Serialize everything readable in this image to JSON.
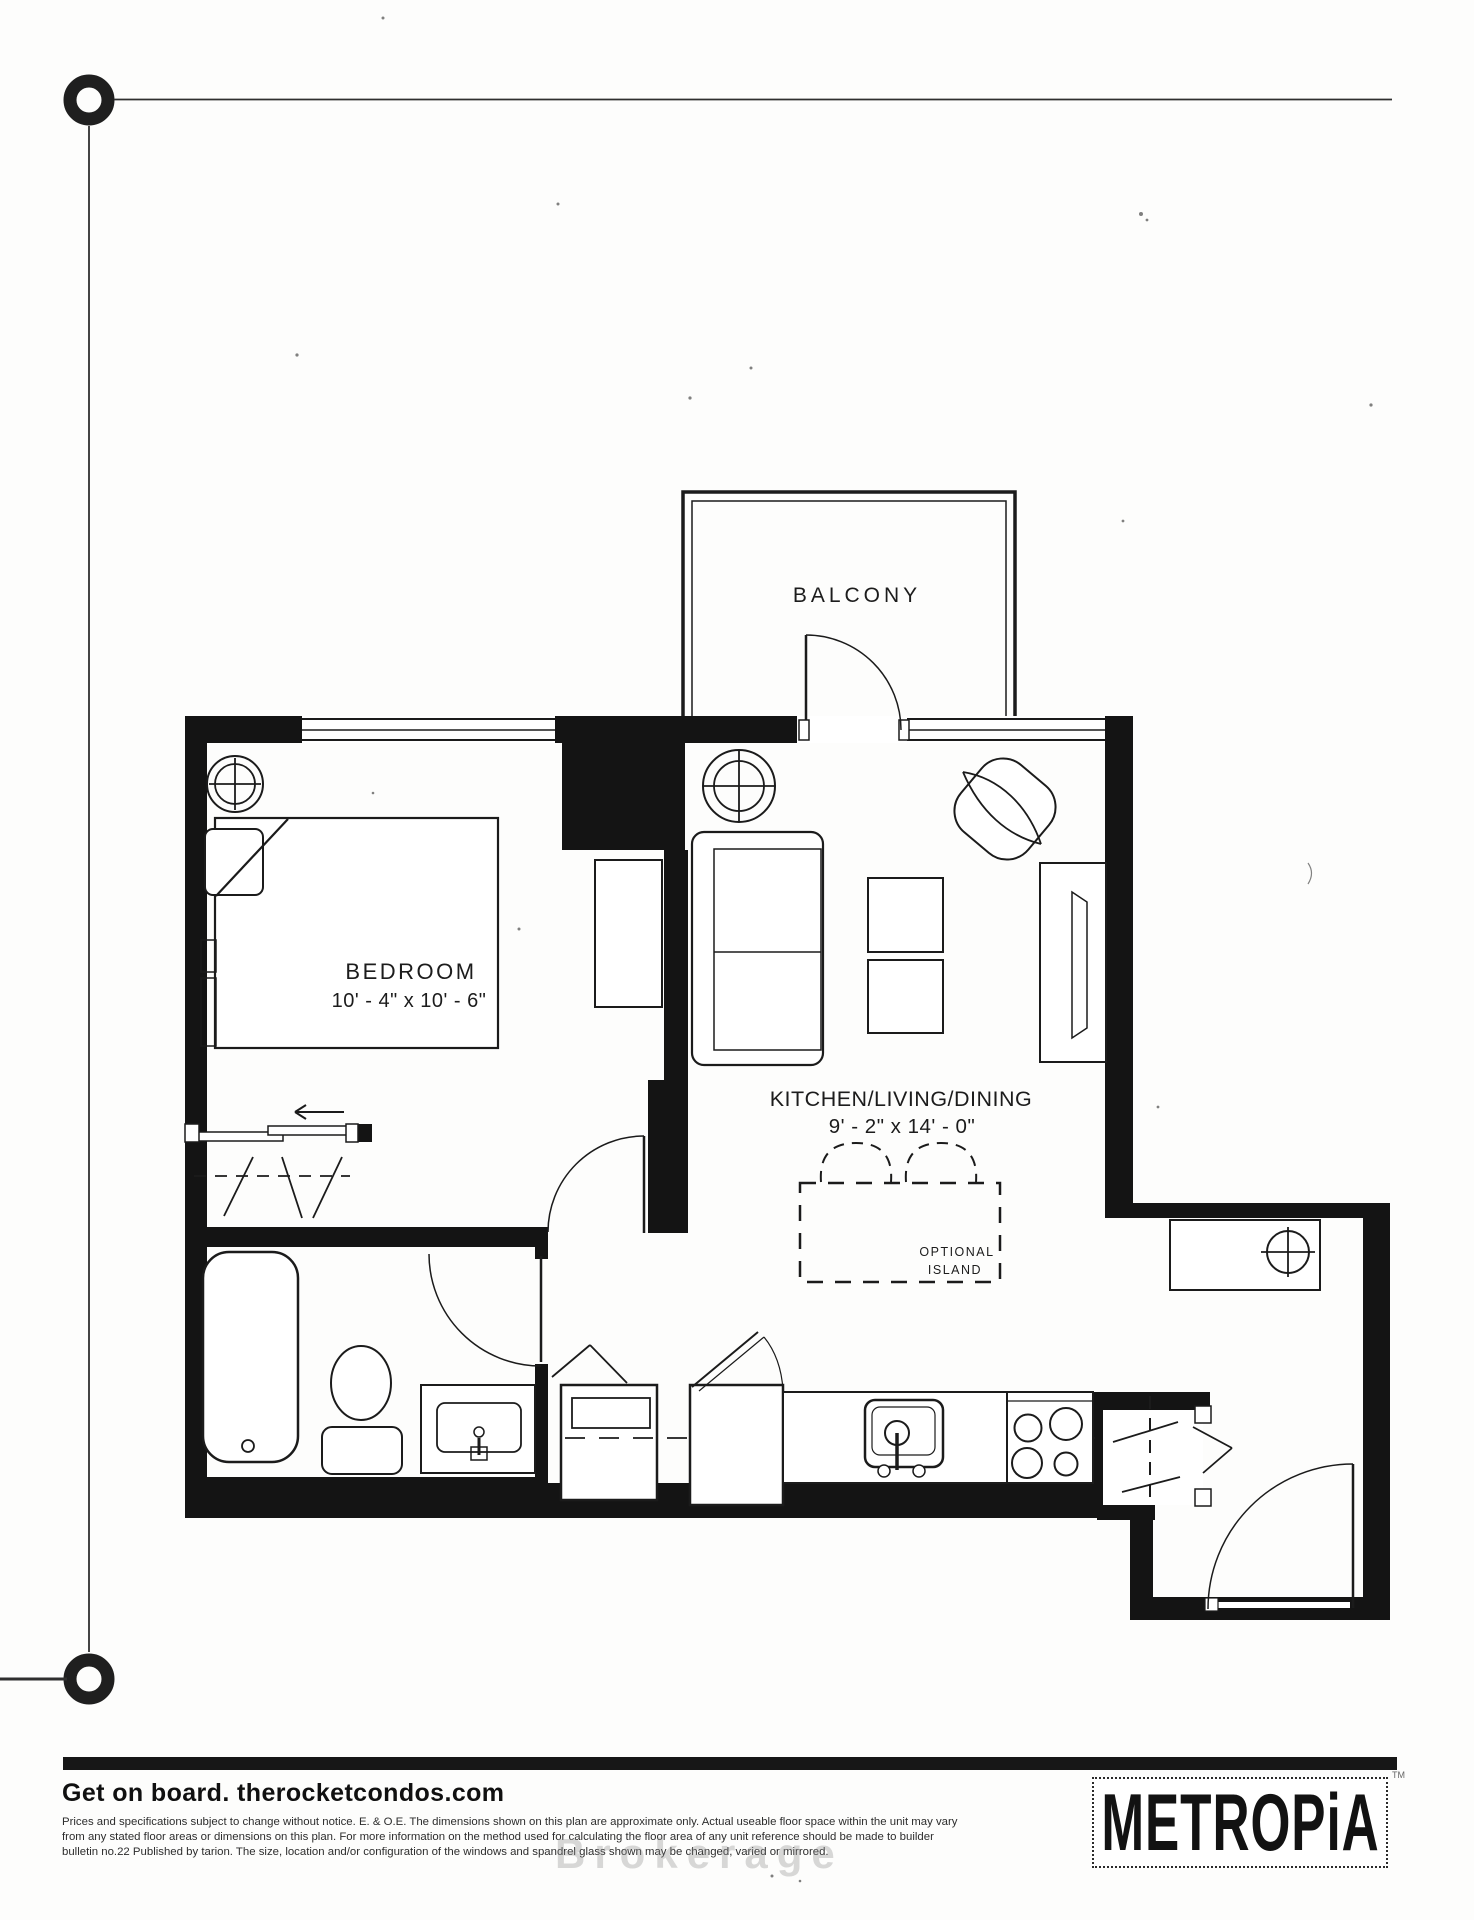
{
  "floorplan": {
    "balcony": {
      "label": "BALCONY"
    },
    "bedroom": {
      "label": "BEDROOM",
      "dimensions": "10' - 4\" x 10' - 6\""
    },
    "kitchen_living_dining": {
      "label": "KITCHEN/LIVING/DINING",
      "dimensions": "9' - 2\" x 14' - 0\""
    },
    "optional_island": {
      "line1": "OPTIONAL",
      "line2": "ISLAND"
    }
  },
  "footer": {
    "tagline": "Get on board. therocketcondos.com",
    "disclaimer": {
      "line1": "Prices and specifications subject to change without notice. E. & O.E. The dimensions shown on this plan are approximate only. Actual useable floor space within the unit may vary",
      "line2": "from any stated floor areas or dimensions on this plan. For more information on the method used for calculating the floor area of any unit reference should be made to builder",
      "line3": "bulletin no.22 Published by tarion. The size, location and/or configuration of the windows and spandrel glass shown may be changed, varied or mirrored."
    },
    "watermark_fragment": "Brokerage",
    "logo": {
      "text": "METROPiA",
      "trademark": "TM"
    }
  },
  "colors": {
    "ink": "#1c1c1c",
    "wall": "#141414",
    "footer_bar": "#171717"
  }
}
